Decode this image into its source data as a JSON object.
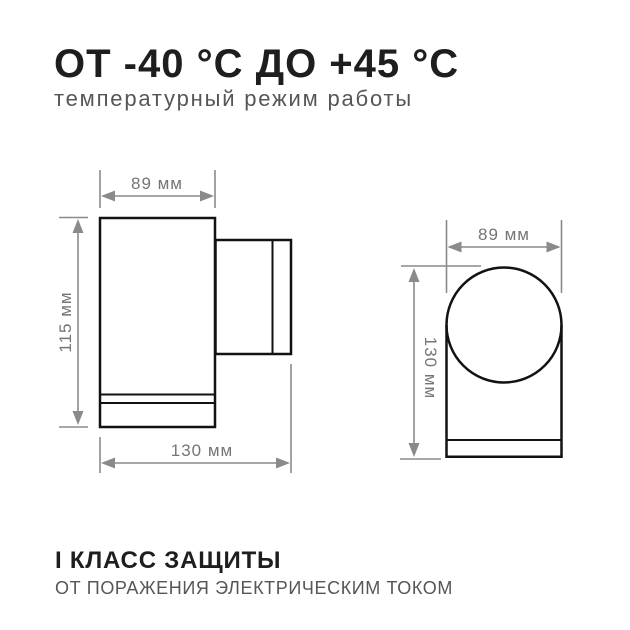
{
  "header": {
    "title": "ОТ -40 °C ДО +45 °C",
    "subtitle": "температурный режим работы"
  },
  "footer": {
    "title": "I КЛАСС ЗАЩИТЫ",
    "subtitle": "ОТ ПОРАЖЕНИЯ ЭЛЕКТРИЧЕСКИМ ТОКОМ"
  },
  "diagram": {
    "description": "wall-lamp dimensional drawing, two views",
    "side_view": {
      "width_label": "89 мм",
      "height_label": "115 мм",
      "depth_label": "130 мм"
    },
    "front_view": {
      "width_label": "89 мм",
      "height_label": "130 мм"
    }
  },
  "colors": {
    "background": "#ffffff",
    "text_primary": "#1e1e1e",
    "text_secondary": "#55565a",
    "drawing_outline": "#121212",
    "dimension_gray": "#8a8a8a",
    "dimension_text": "#757575"
  }
}
